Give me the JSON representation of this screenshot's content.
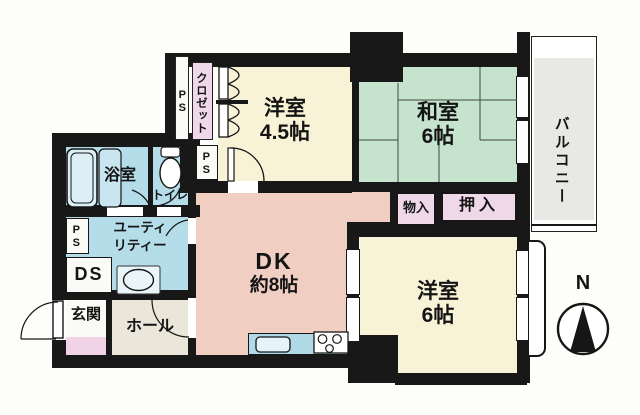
{
  "floorplan": {
    "rooms": {
      "western_room_1": {
        "name": "洋室",
        "size": "4.5帖"
      },
      "japanese_room": {
        "name": "和室",
        "size": "6帖"
      },
      "western_room_2": {
        "name": "洋室",
        "size": "6帖"
      },
      "dining_kitchen": {
        "name": "DK",
        "size": "約8帖"
      },
      "balcony": {
        "name": "バルコニー"
      },
      "bathroom": {
        "name": "浴室"
      },
      "toilet": {
        "name": "トイレ"
      },
      "utility": {
        "line1": "ユーティ",
        "line2": "リティー"
      },
      "duct_space": {
        "name": "DS"
      },
      "entrance": {
        "name": "玄関"
      },
      "hall": {
        "name": "ホール"
      },
      "closet": {
        "name": "クロゼット"
      },
      "storage": {
        "name": "物入"
      },
      "futon_closet": {
        "name": "押入"
      },
      "pipe_space": {
        "name": "PS"
      }
    },
    "compass": {
      "north": "N"
    },
    "colors": {
      "wall": "#181818",
      "western_room": "#F8F3D6",
      "japanese_room": "#C6E3CD",
      "dining_kitchen": "#F0CEC2",
      "water_area": "#B4DCE9",
      "closet_pink": "#EFD9E9",
      "balcony_gray": "#E8E8E4",
      "hall_beige": "#EAE6DA",
      "entrance_tile": "#F0D3E7"
    }
  }
}
